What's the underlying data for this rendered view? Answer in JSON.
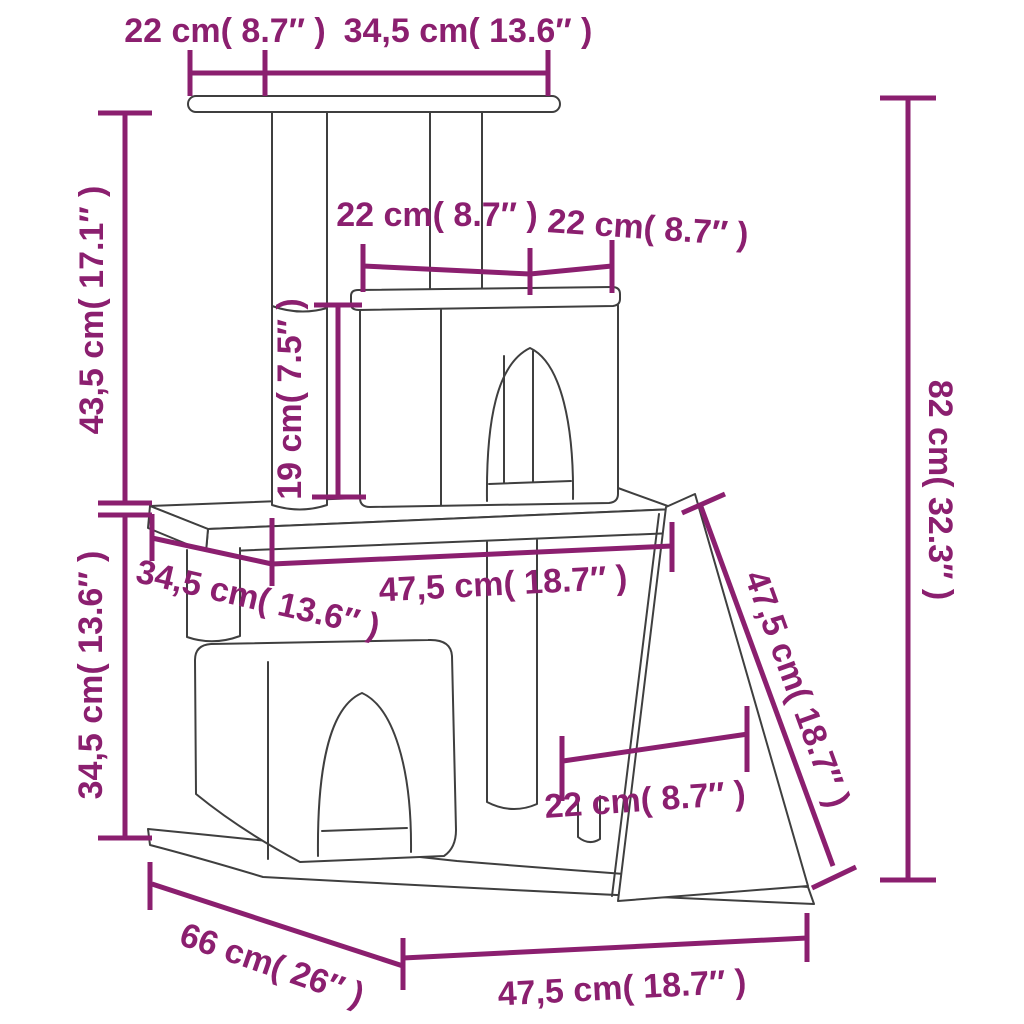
{
  "page": {
    "background": "#ffffff"
  },
  "diagram": {
    "subject": "Cat tree with condos, scratching posts and ramp — dimension drawing",
    "colors": {
      "dimension_lines": "#8b1f6f",
      "outlines": "#3f3f3f",
      "fill": "#ffffff"
    },
    "labels": {
      "top_overhang": "22 cm( 8.7″ )",
      "top_board": "34,5 cm( 13.6″ )",
      "upper_section_height": "43,5 cm( 17.1″ )",
      "condo_top_left": "22 cm( 8.7″ )",
      "condo_top_right": "22 cm( 8.7″ )",
      "post_height": "19 cm( 7.5″ )",
      "total_height": "82 cm( 32.3″ )",
      "platform_depth": "34,5 cm( 13.6″ )",
      "platform_width": "47,5 cm( 18.7″ )",
      "ramp_length": "47,5 cm( 18.7″ )",
      "lower_section_height": "34,5 cm( 13.6″ )",
      "ramp_width": "22 cm( 8.7″ )",
      "base_depth": "66 cm( 26″ )",
      "base_width": "47,5 cm( 18.7″ )"
    },
    "measurements": [
      {
        "name": "top board overhang",
        "cm": 22,
        "inch": 8.7
      },
      {
        "name": "top board width",
        "cm": 34.5,
        "inch": 13.6
      },
      {
        "name": "upper section height",
        "cm": 43.5,
        "inch": 17.1
      },
      {
        "name": "condo top width (left)",
        "cm": 22,
        "inch": 8.7
      },
      {
        "name": "condo top width (right)",
        "cm": 22,
        "inch": 8.7
      },
      {
        "name": "post height",
        "cm": 19,
        "inch": 7.5
      },
      {
        "name": "overall height",
        "cm": 82,
        "inch": 32.3
      },
      {
        "name": "middle platform depth",
        "cm": 34.5,
        "inch": 13.6
      },
      {
        "name": "middle platform width",
        "cm": 47.5,
        "inch": 18.7
      },
      {
        "name": "ramp length",
        "cm": 47.5,
        "inch": 18.7
      },
      {
        "name": "lower section height",
        "cm": 34.5,
        "inch": 13.6
      },
      {
        "name": "ramp width",
        "cm": 22,
        "inch": 8.7
      },
      {
        "name": "base depth",
        "cm": 66,
        "inch": 26
      },
      {
        "name": "base width",
        "cm": 47.5,
        "inch": 18.7
      }
    ]
  }
}
